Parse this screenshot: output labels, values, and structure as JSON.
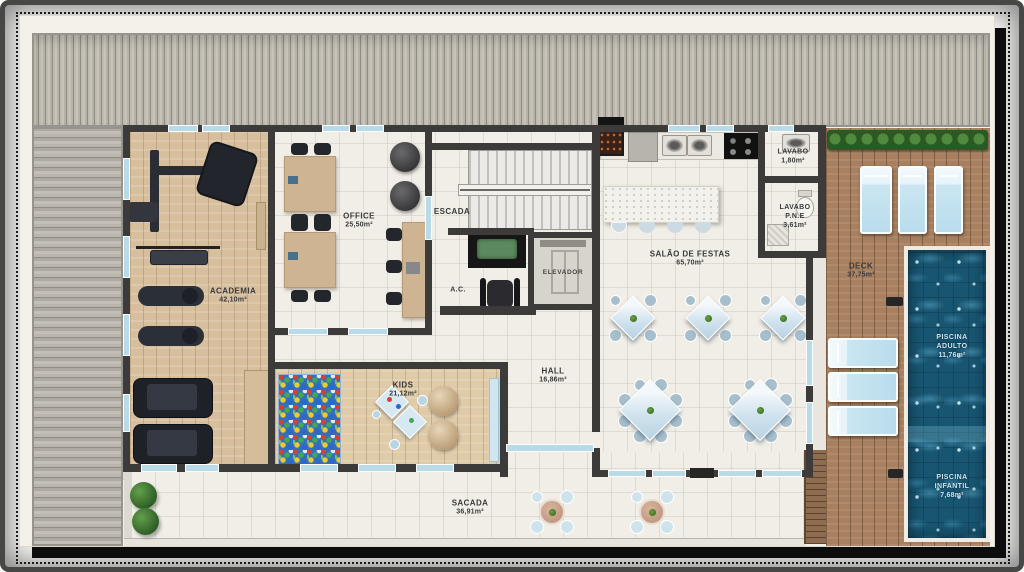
{
  "plan": {
    "rooms": {
      "academia": {
        "name": "ACADEMIA",
        "area": "42,10m²"
      },
      "office": {
        "name": "OFFICE",
        "area": "25,50m²"
      },
      "escada": {
        "name": "ESCADA"
      },
      "ac": {
        "name": "A.C."
      },
      "elevador": {
        "name": "ELEVADOR"
      },
      "salao_de_festas": {
        "name": "SALÃO DE FESTAS",
        "area": "65,70m²"
      },
      "lavabo": {
        "name": "LAVABO",
        "area": "1,80m²"
      },
      "lavabo_pne": {
        "name": "LAVABO",
        "name2": "P.N.E",
        "area": "3,61m²"
      },
      "deck": {
        "name": "DECK",
        "area": "37,75m²"
      },
      "piscina_adulto": {
        "name": "PISCINA",
        "name2": "ADULTO",
        "area": "11,76m²"
      },
      "piscina_infantil": {
        "name": "PISCINA",
        "name2": "INFANTIL",
        "area": "7,68m²"
      },
      "kids": {
        "name": "KIDS",
        "area": "21,12m²"
      },
      "hall": {
        "name": "HALL",
        "area": "16,86m²"
      },
      "sacada": {
        "name": "SACADA",
        "area": "36,91m²"
      }
    },
    "colors": {
      "wall": "#3c3b39",
      "window": "#b9dbe7",
      "sheet": "#f4f1ea",
      "roof_stripe_light": "#c8c4ba",
      "roof_stripe_dark": "#8f8c85",
      "gym_wood": "#d7bf9e",
      "deck_wood": "#a8805f",
      "pool_water": "#185571",
      "hedge_green": "#2a5a24",
      "ballpit_blue": "#3170bd",
      "label_text": "#3a3a3a",
      "pool_label_text": "#cfe2ea",
      "shadow": "#0d0d0d"
    }
  }
}
